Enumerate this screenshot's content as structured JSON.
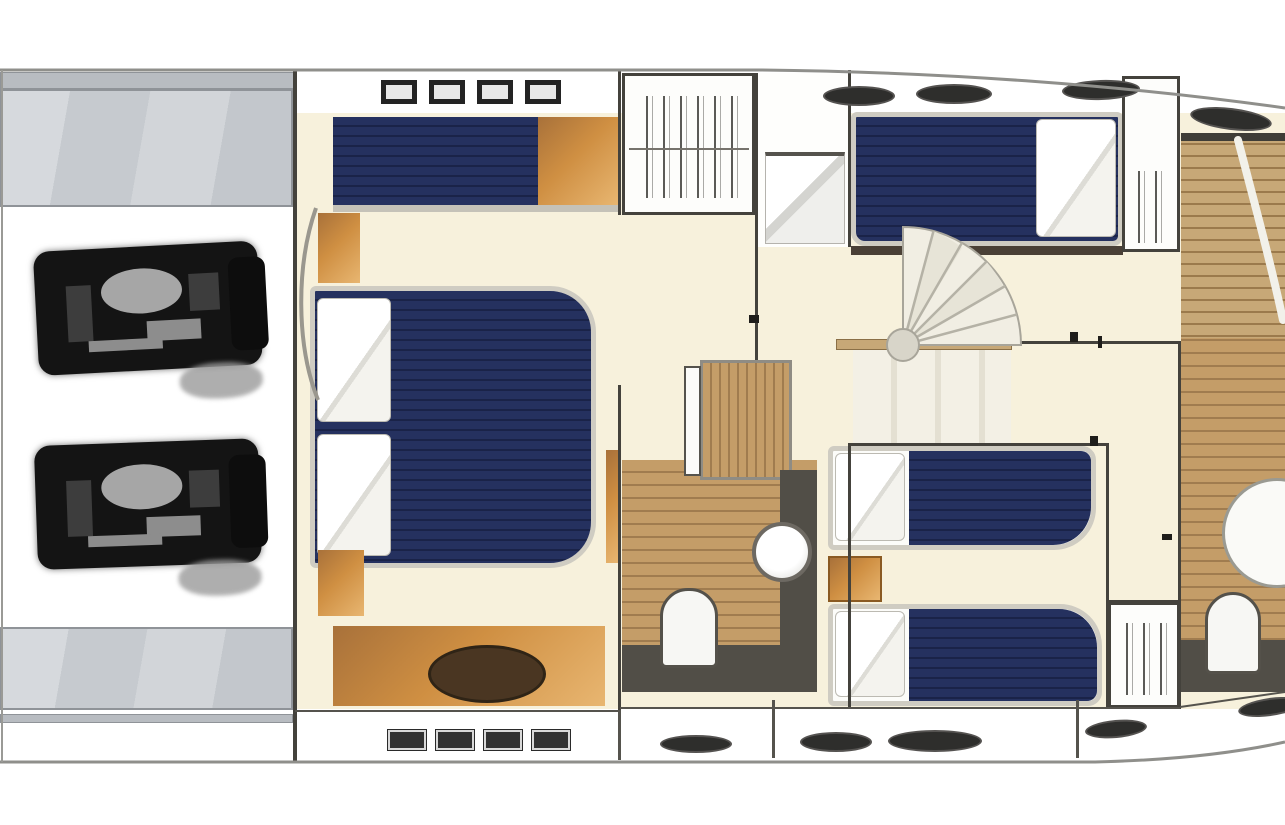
{
  "diagram_type": "yacht-lower-deck-floor-plan",
  "features": [
    "swim-platform",
    "engine-room",
    "port-engine",
    "starboard-engine",
    "master-cabin",
    "master-double-bed",
    "master-sofa",
    "master-dresser",
    "hanging-locker",
    "lobby",
    "spiral-staircase",
    "companionway-stairs",
    "vip-cabin",
    "vip-bed",
    "twin-cabin",
    "twin-bed",
    "nightstand",
    "bathroom-midship",
    "bathroom-forward",
    "shower",
    "toilet",
    "washbasin",
    "porthole",
    "hull-window"
  ],
  "palette": {
    "wall": "#44423c",
    "wall-light": "#55534d",
    "hull": "#90908c",
    "cream": "#f7f1dc",
    "navy": "#25315f",
    "navy-dark": "#1a2348",
    "wood": "#cf8f42",
    "wood-dark": "#a8713a",
    "wood-hi": "#e8b671",
    "plank": "#c49d68",
    "plank-line": "#a07c4f",
    "teak": "#c7a877",
    "teak-line": "#9b7a4c",
    "platform-strip": "#b8bcc1",
    "platform-edge": "#8f9398",
    "frame": "#cfccc2",
    "counter": "#514e47",
    "fix-border": "#8f8c84",
    "engine": "#141414",
    "floor-gray": "#f3f0e5",
    "floor-gray-dk": "#e4e0d2"
  }
}
